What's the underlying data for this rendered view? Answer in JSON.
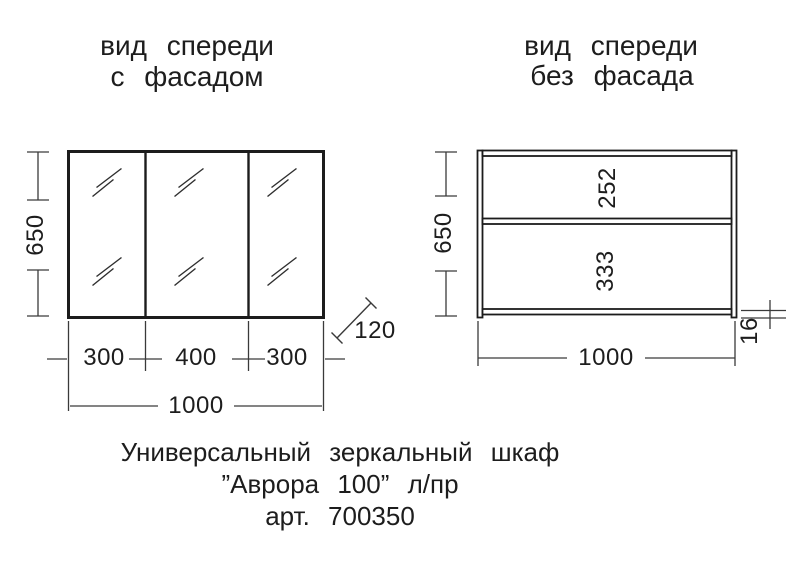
{
  "page": {
    "background": "#ffffff",
    "line_color": "#1c1c1c",
    "text_color": "#1d1d1d"
  },
  "left_view": {
    "title_line1": "вид спереди",
    "title_line2": "с фасадом",
    "height_mm": "650",
    "door_left_mm": "300",
    "door_center_mm": "400",
    "door_right_mm": "300",
    "total_width_mm": "1000",
    "depth_mm": "120"
  },
  "right_view": {
    "title_line1": "вид спереди",
    "title_line2": "без фасада",
    "height_mm": "650",
    "upper_section_mm": "252",
    "lower_section_mm": "333",
    "total_width_mm": "1000",
    "panel_thickness_mm": "16"
  },
  "caption": {
    "line1": "Универсальный зеркальный шкаф",
    "line2": "”Аврора 100” л/пр",
    "line3": "арт. 700350"
  }
}
